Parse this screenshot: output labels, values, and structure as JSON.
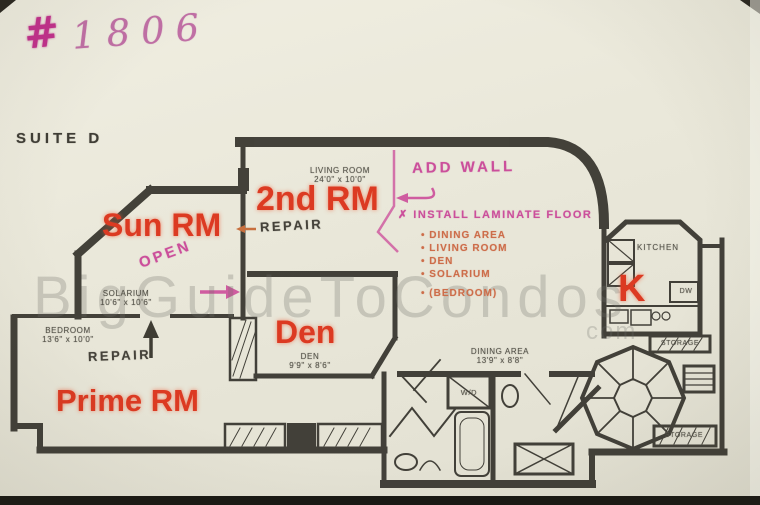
{
  "page": {
    "unit_prefix": "#",
    "unit_number": "1806",
    "suite": "SUITE D",
    "watermark": "BigGuideToCondos",
    "watermark_suffix": "com"
  },
  "room_labels": {
    "sun": "Sun RM",
    "second": "2nd RM",
    "den": "Den",
    "prime": "Prime RM",
    "kitchen": "K"
  },
  "printed": {
    "living": {
      "name": "LIVING ROOM",
      "dims": "24'0\" x 10'0\""
    },
    "solarium": {
      "name": "SOLARIUM",
      "dims": "10'6\" x 10'6\""
    },
    "bedroom": {
      "name": "BEDROOM",
      "dims": "13'6\" x 10'0\""
    },
    "den": {
      "name": "DEN",
      "dims": "9'9\" x 8'6\""
    },
    "dining": {
      "name": "DINING AREA",
      "dims": "13'9\" x 8'8\""
    },
    "kitchen": "KITCHEN",
    "dishwasher": "DW",
    "storage_mid": "STORAGE",
    "storage_bottom": "STORAGE",
    "washer_dryer": "W/D"
  },
  "annotations": {
    "add_wall": "ADD WALL",
    "install_prefix": "✗",
    "install_title": "INSTALL LAMINATE FLOOR",
    "install_items": [
      "DINING AREA",
      "LIVING ROOM",
      "DEN",
      "SOLARIUM",
      "(BEDROOM)"
    ],
    "repair_living": "REPAIR",
    "repair_bedroom": "REPAIR",
    "open": "OPEN"
  },
  "colors": {
    "room_label_red": "#dc3a22",
    "marker_pink": "#cb4f9b",
    "marker_orange": "#c8703f",
    "ink": "#35332c",
    "paper": "#e9e7d9"
  }
}
